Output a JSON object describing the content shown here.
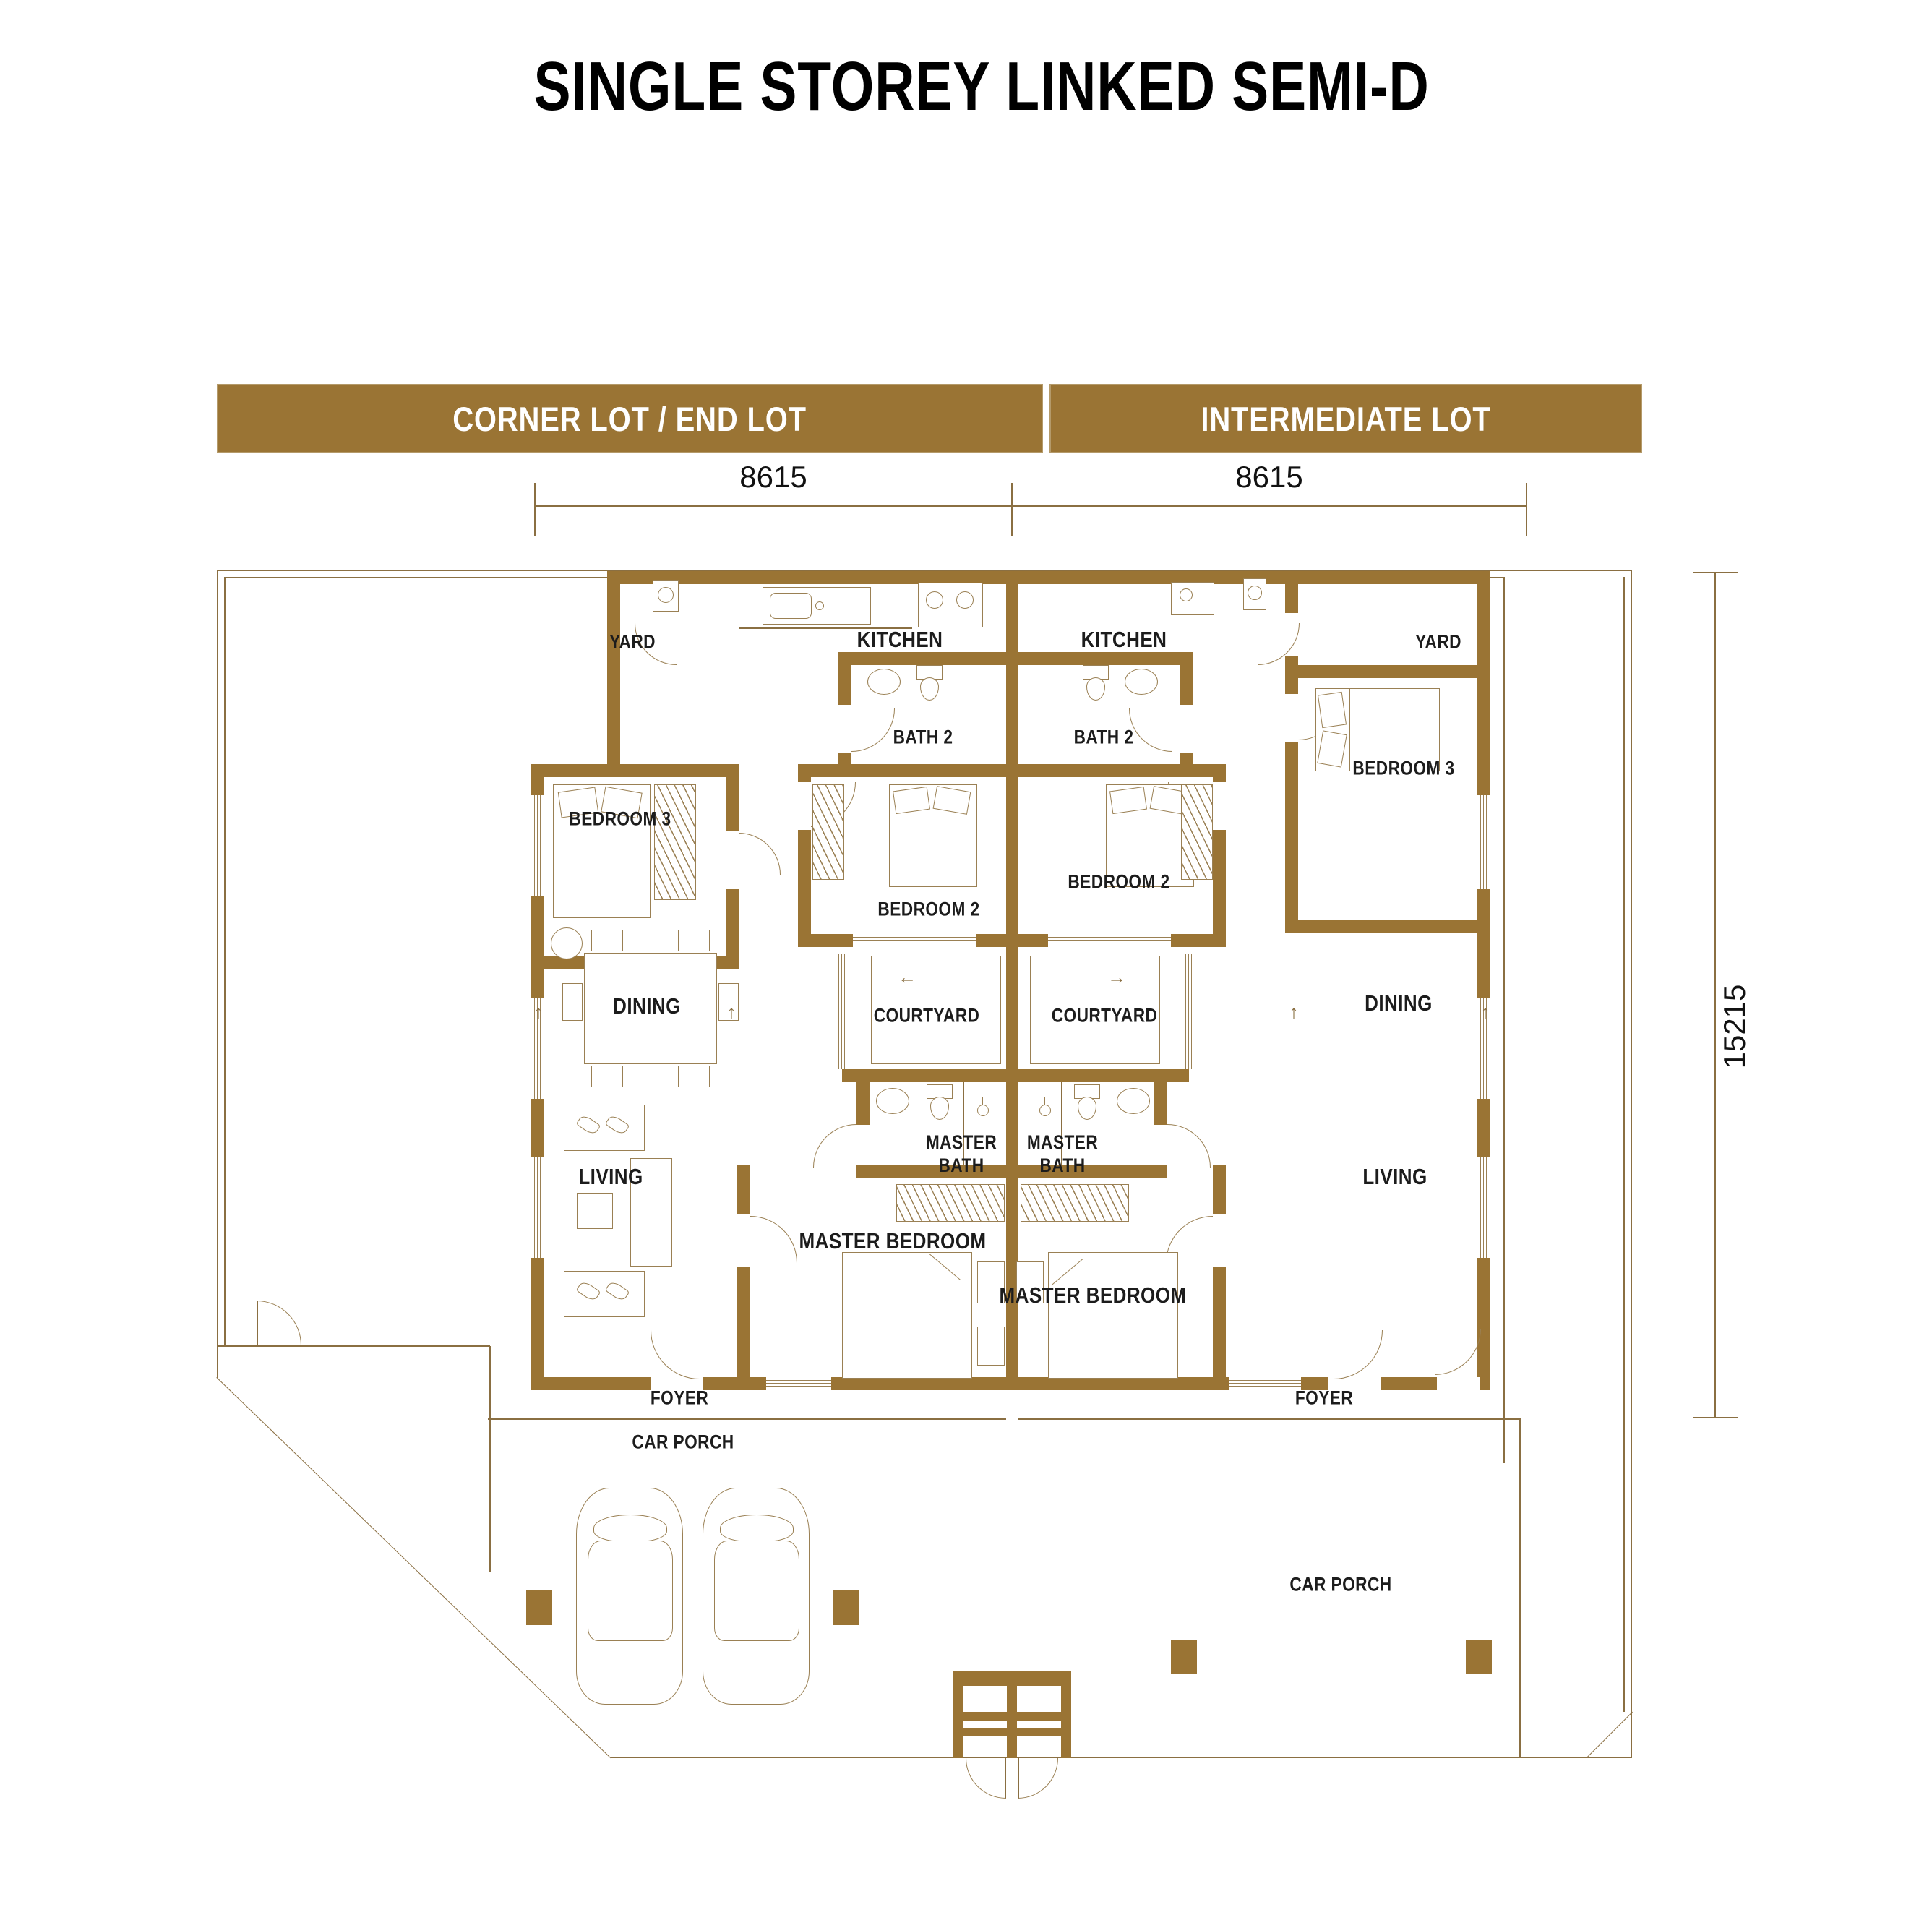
{
  "title": "SINGLE STOREY LINKED SEMI-D",
  "colors": {
    "wall": "#9A7434",
    "thin_line": "#9a8054",
    "header_bg": "#9A7434",
    "header_text": "#ffffff",
    "label_text": "#1c1c1c"
  },
  "headers": {
    "corner": "CORNER LOT / END LOT",
    "intermediate": "INTERMEDIATE  LOT"
  },
  "dimensions": {
    "top_left": "8615",
    "top_right": "8615",
    "right": "15215"
  },
  "units": {
    "corner": {
      "name": "CORNER LOT / END LOT",
      "rooms": {
        "yard": "YARD",
        "kitchen": "KITCHEN",
        "bath2": "BATH 2",
        "bedroom3": "BEDROOM 3",
        "bedroom2": "BEDROOM 2",
        "dining": "DINING",
        "courtyard": "COURTYARD",
        "master_bath": "MASTER BATH",
        "living": "LIVING",
        "master_bedroom": "MASTER BEDROOM",
        "foyer": "FOYER",
        "car_porch": "CAR PORCH"
      }
    },
    "intermediate": {
      "name": "INTERMEDIATE LOT",
      "rooms": {
        "yard": "YARD",
        "kitchen": "KITCHEN",
        "bath2": "BATH 2",
        "bedroom3": "BEDROOM 3",
        "bedroom2": "BEDROOM 2",
        "dining": "DINING",
        "courtyard": "COURTYARD",
        "master_bath": "MASTER BATH",
        "living": "LIVING",
        "master_bedroom": "MASTER BEDROOM",
        "foyer": "FOYER",
        "car_porch": "CAR PORCH"
      }
    }
  },
  "misc": {
    "arrow_up": "↑",
    "arrow_left": "←",
    "arrow_right": "→"
  }
}
